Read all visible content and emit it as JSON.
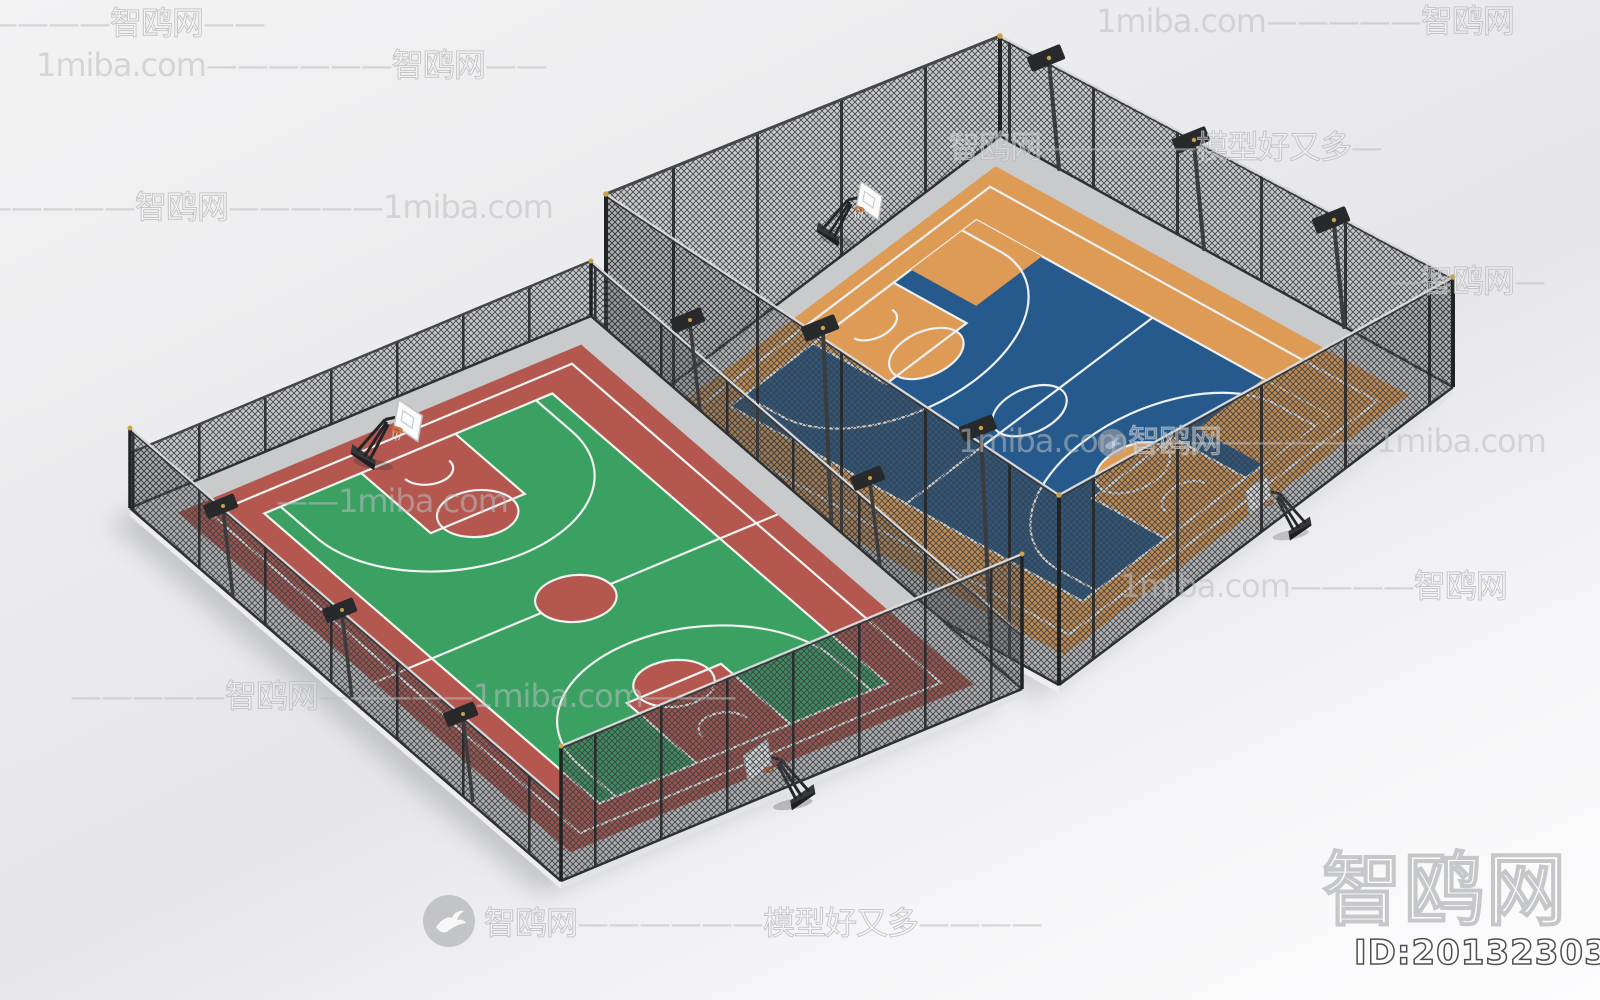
{
  "watermark": {
    "site": "1miba.com",
    "brand": "智鸥网",
    "slogan": "模型好又多",
    "id_text": "ID:201323036",
    "dash6": "——————",
    "dash5": "—————",
    "dash4": "————",
    "dash3": "———",
    "dash2": "——",
    "dash1": "—"
  },
  "scene": {
    "subject": "two fenced outdoor basketball courts, isometric 3d render",
    "background_top": "#f3f3f4",
    "background_bottom": "#fdfdfe",
    "concrete_color": "#c9cacb",
    "left_court": {
      "name": "green and red basketball court",
      "surface_color": "#3aa163",
      "apron_color": "#b4574f",
      "key_color": "#b4574f",
      "line_color": "#f2f4f1"
    },
    "right_court": {
      "name": "blue and orange basketball court",
      "surface_color": "#265a8c",
      "apron_color": "#de9b55",
      "key_color": "#de9b55",
      "line_color": "#edf1f4"
    },
    "fence": {
      "mesh_color": "#3e4042",
      "frame_color": "#2e3032",
      "rail_light_color": "#d8d9da",
      "post_cap_color": "#c9a44a"
    },
    "floodlight_color": "#27292b",
    "hoop": {
      "stand_color": "#1e2022",
      "backboard_color": "#fbfbfc",
      "rim_color": "#d8722c"
    }
  }
}
